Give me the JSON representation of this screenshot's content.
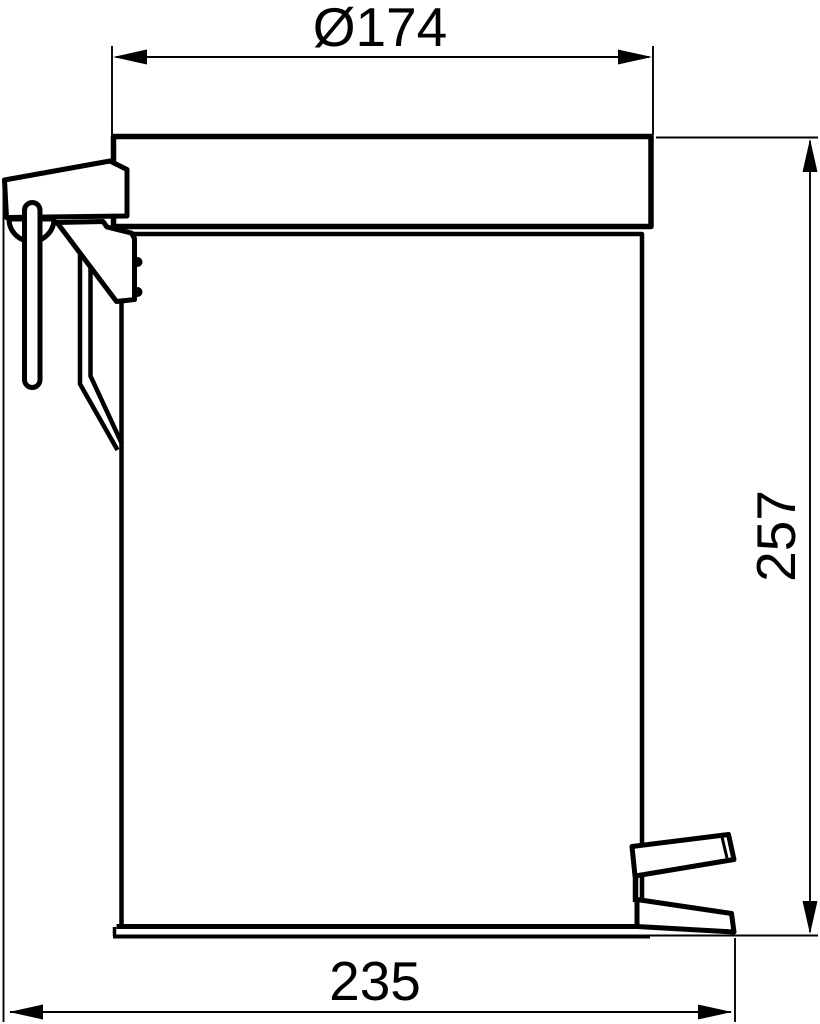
{
  "figure": {
    "kind": "technical-line-drawing",
    "view": "side-elevation-pedal-bin",
    "background_color": "#ffffff",
    "line_color": "#000000"
  },
  "dimensions": {
    "diameter": {
      "label": "Ø174",
      "value": 174,
      "orientation": "horizontal",
      "position": "top"
    },
    "height": {
      "label": "257",
      "value": 257,
      "orientation": "vertical",
      "position": "right"
    },
    "depth": {
      "label": "235",
      "value": 235,
      "orientation": "horizontal",
      "position": "bottom"
    }
  }
}
